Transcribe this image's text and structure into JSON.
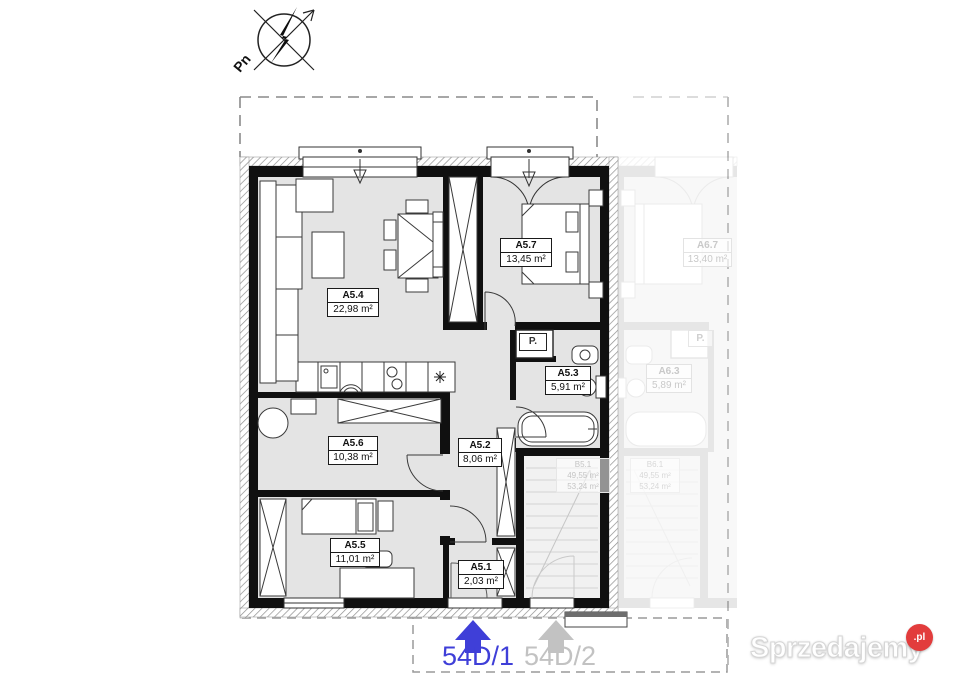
{
  "compass": {
    "label": "Pn"
  },
  "rooms": [
    {
      "id": "A5.4",
      "area": "22,98 m²"
    },
    {
      "id": "A5.7",
      "area": "13,45 m²"
    },
    {
      "id": "A5.3",
      "area": "5,91 m²"
    },
    {
      "id": "A5.6",
      "area": "10,38 m²"
    },
    {
      "id": "A5.2",
      "area": "8,06 m²"
    },
    {
      "id": "A5.5",
      "area": "11,01 m²"
    },
    {
      "id": "A5.1",
      "area": "2,03 m²"
    }
  ],
  "closet_label": "P.",
  "stair": {
    "id": "B5.1",
    "area1": "49,55 m²",
    "area2": "53,24 m²"
  },
  "ghost": {
    "rooms": [
      {
        "id": "A6.7",
        "area": "13,40 m²"
      },
      {
        "id": "A6.3",
        "area": "5,89 m²"
      }
    ],
    "closet_label": "P.",
    "stair": {
      "id": "B6.1",
      "area1": "49,55 m²",
      "area2": "53,24 m²"
    }
  },
  "units": {
    "primary": {
      "label": "54D/1",
      "color": "#3f3fd8"
    },
    "secondary": {
      "label": "54D/2",
      "color": "#c2c2c2"
    }
  },
  "watermark": {
    "name": "Sprzedajemy",
    "tld": ".pl"
  }
}
